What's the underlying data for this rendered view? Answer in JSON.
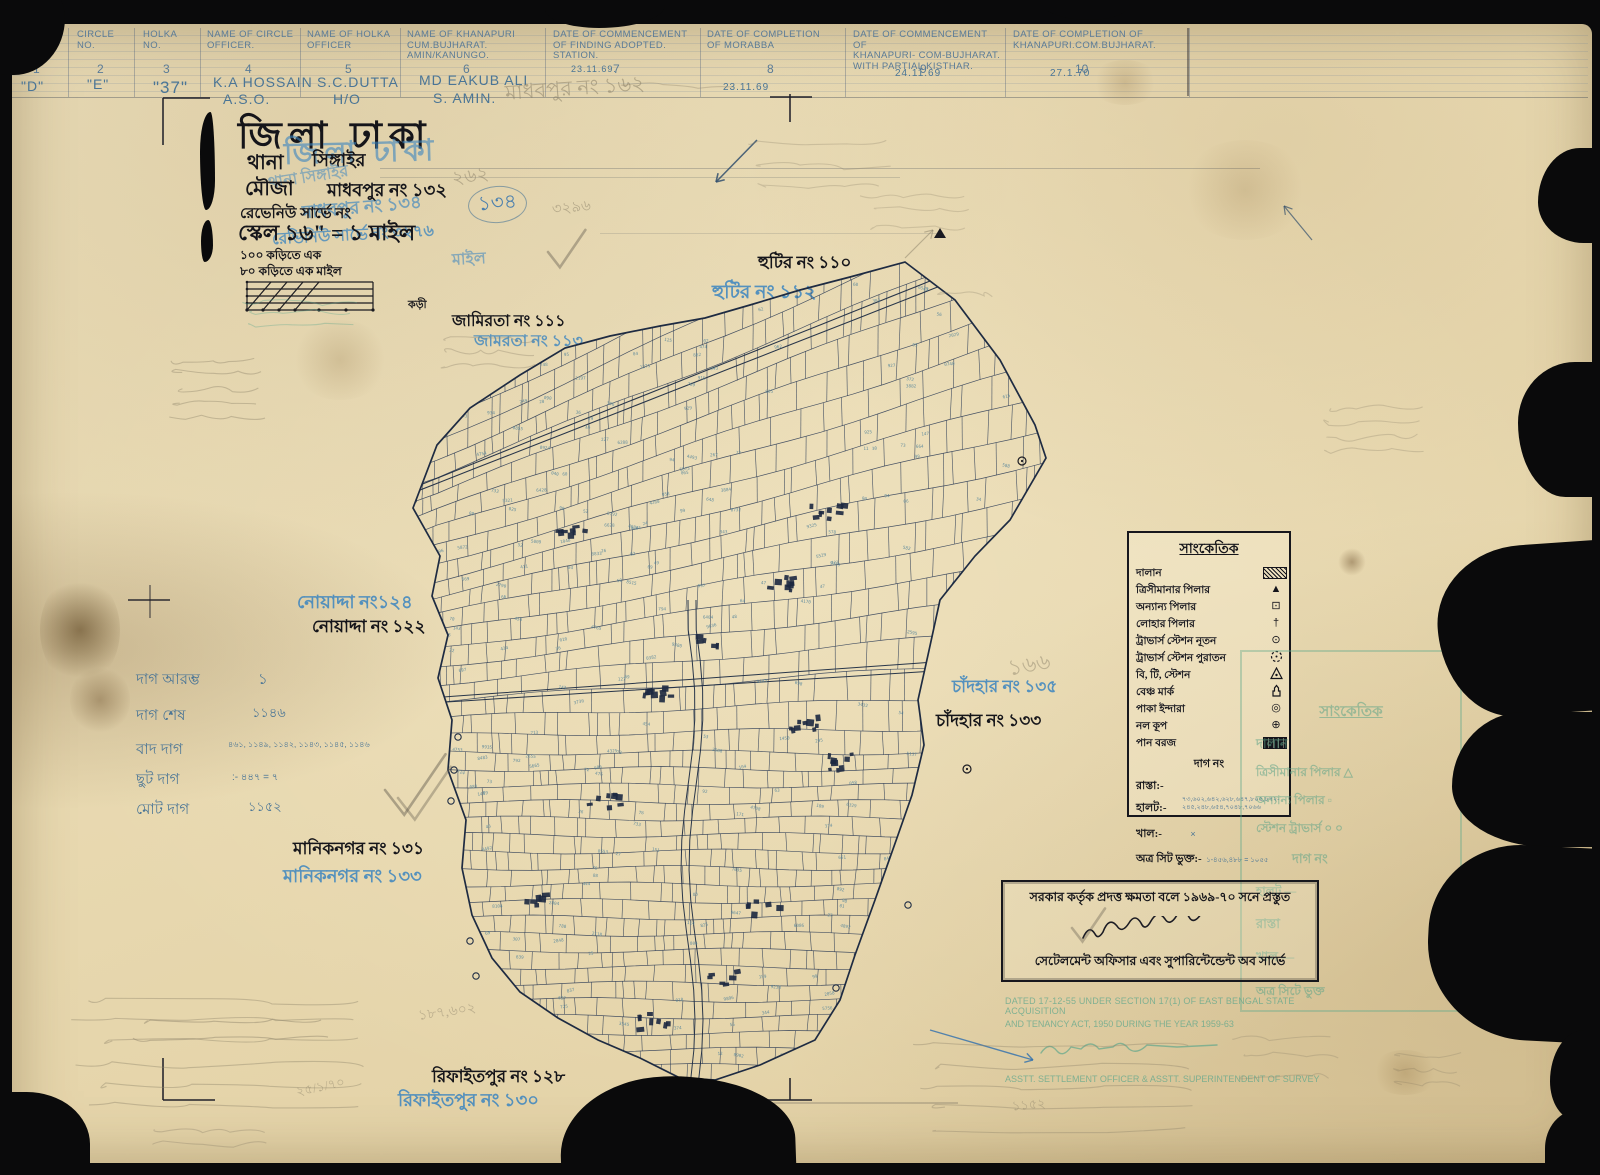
{
  "colors": {
    "paper": "#e9dcb6",
    "ink": "#15151a",
    "blue_stamp": "#3b85c0",
    "pencil": "#8b8169",
    "teal_stamp": "#58a58b",
    "map_ink": "#25334d",
    "map_numbers": "#527f91"
  },
  "header": {
    "columns": [
      {
        "no": "1",
        "label": "BLOCK\nNO.",
        "value": "\"D\"",
        "value2": ""
      },
      {
        "no": "2",
        "label": "CIRCLE\nNO.",
        "value": "\"E\"",
        "value2": ""
      },
      {
        "no": "3",
        "label": "HOLKA\nNO.",
        "value": "\"37\"",
        "value2": ""
      },
      {
        "no": "4",
        "label": "NAME OF CIRCLE\nOFFICER.",
        "value": "K.A HOSSAIN",
        "value2": "A.S.O."
      },
      {
        "no": "5",
        "label": "NAME OF HOLKA\nOFFICER",
        "value": "S.C.DUTTA",
        "value2": "H/O"
      },
      {
        "no": "6",
        "label": "NAME OF KHANAPURI\nCUM.BUJHARAT.\nAMIN/KANUNGO.",
        "value": "MD EAKUB ALI",
        "value2": "S. AMIN."
      },
      {
        "no": "7",
        "label": "DATE OF COMMENCEMENT\nOF FINDING ADOPTED.\nSTATION.",
        "value": "23.11.69.",
        "value2": ""
      },
      {
        "no": "8",
        "label": "DATE OF COMPLETION\nOF MORABBA",
        "value": "23.11.69",
        "value2": ""
      },
      {
        "no": "9",
        "label": "DATE OF COMMENCEMENT OF\nKHANAPURI- COM-BUJHARAT.\nWITH PARTIAL KISTHAR.",
        "value": "24.11.69",
        "value2": ""
      },
      {
        "no": "10",
        "label": "DATE OF COMPLETION OF\nKHANAPURI.COM.BUJHARAT.",
        "value": "27.1.70",
        "value2": ""
      }
    ],
    "pencil_note": "মাধবপুর নং ১৬২"
  },
  "title_block": {
    "district_black": "জিলা ঢাকা",
    "district_blue": "জিলা ঢাকা",
    "thana_label": "থানা",
    "thana_value": "সিঙ্গাইর",
    "thana_blue": "থানা সিঙ্গাইর",
    "mouza_label": "মৌজা",
    "mouza_value": "মাধবপুর নং ১৩২",
    "mouza_blue": "মাধবপুর নং ১৩৪",
    "mouza_blue_circled": "১৩৪",
    "revenue_line": "রেভেনিউ সার্ভে নং",
    "revenue_blue": "রেভিনিউ সার্ভে নং ৩২৭৬",
    "scale_line": "স্কেল ১৬\" = ১ মাইল",
    "scale_blue_tail": "মাইল",
    "kari_line1": "১০০ কড়িতে এক",
    "kari_line2": "৮০ কড়িতে এক মাইল",
    "scalebar_unit": "কড়ী",
    "pencil_262": "২৬২",
    "pencil_162": "১৬২",
    "pencil_3296": "৩২৯৬"
  },
  "neighbors": {
    "hutir": {
      "black": "হুটির নং ১১০",
      "blue": "হুটির নং ১১২"
    },
    "jamirta": {
      "black": "জামিরতা নং ১১১",
      "blue": "জামরতা নং ১১৩"
    },
    "noyadda": {
      "blue": "নোয়াদ্দা নং১২৪",
      "black": "নোয়াদ্দা নং ১২২"
    },
    "maniknagar": {
      "black": "মানিকনগর নং ১৩১",
      "blue": "মানিকনগর নং ১৩৩"
    },
    "chandhar": {
      "blue": "চাঁদহার নং ১৩৫",
      "black": "চাঁদহার নং ১৩৩",
      "pencil": "১৬৬"
    },
    "rifaitpur": {
      "black": "রিফাইতপুর নং ১২৮",
      "blue": "রিফাইতপুর নং ১৩০"
    }
  },
  "stats": {
    "rows": [
      {
        "label": "দাগ আরম্ভ",
        "value": "১"
      },
      {
        "label": "দাগ শেষ",
        "value": "১১৪৬"
      },
      {
        "label": "বাদ দাগ",
        "value": "৪৬১, ১১৪৯, ১১৪২, ১১৪৩, ১১৪৫, ১১৪৬"
      },
      {
        "label": "ছুট দাগ",
        "value": ":- ৪৪৭ = ৭"
      },
      {
        "label": "মোট দাগ",
        "value": "১১৫২"
      }
    ]
  },
  "legend": {
    "title": "সাংকেতিক",
    "rows": [
      {
        "label": "দালান",
        "symbol": "hatched-rect"
      },
      {
        "label": "ত্রিসীমানার পিলার",
        "symbol": "triangle"
      },
      {
        "label": "অন্যান্য পিলার",
        "symbol": "square-dot"
      },
      {
        "label": "লোহার পিলার",
        "symbol": "dagger"
      },
      {
        "label": "ট্রাভার্স স্টেশন নূতন",
        "symbol": "circle-dot"
      },
      {
        "label": "ট্রাভার্স স্টেশন পুরাতন",
        "symbol": "dashed-circle"
      },
      {
        "label": "বি, টি, স্টেশন",
        "symbol": "triangle-dot"
      },
      {
        "label": "বেঞ্চ মার্ক",
        "symbol": "benchmark"
      },
      {
        "label": "পাকা ইন্দারা",
        "symbol": "double-circle"
      },
      {
        "label": "নল কূপ",
        "symbol": "circle-cross"
      },
      {
        "label": "পান বরজ",
        "symbol": "dark-hatched-rect"
      }
    ],
    "dag_no": "দাগ নং",
    "rasta": "রাস্তা:-",
    "halot": "হালট:-",
    "halot_numbers": "৭৩,৬০২,৬৪২,৬২৮,৬৪৭,৮০৫,৮৭২-\n২৪৫,২৪৮,৬৫৪,৭০৪৮,৭০৬৬",
    "khal": "খাল:-",
    "khal_value": "×",
    "sheet": "অত্র সিট ভুক্ত:-",
    "sheet_numbers": "১-৪৫৬,৪৮৮ = ১০৫৫"
  },
  "green_legend": {
    "title": "সাংকেতিক",
    "lines": [
      "দালান",
      "ত্রিসীমানার পিলার   △",
      "অন্যান্য পিলার   ▫",
      "স্টেশন  ট্রাভার্স   ০ ০",
      "দাগ নং",
      "হালট  —",
      "রাস্তা",
      "খাল  —",
      "অত্র সিটে ভুক্ত"
    ]
  },
  "stamp": {
    "line1": "সরকার কর্তৃক প্রদত্ত ক্ষমতা বলে ১৯৬৯-৭০ সনে প্রস্তুত",
    "line2": "সেটেলমেন্ট অফিসার এবং সুপারিন্টেন্ডেন্ট অব সার্ভে"
  },
  "green_stamp": {
    "line1": "DATED 17-12-55 UNDER SECTION 17(1) OF EAST BENGAL STATE ACQUISITION",
    "line2": "AND TENANCY ACT, 1950 DURING THE YEAR 1959-63",
    "line3": "ASSTT. SETTLEMENT OFFICER & ASSTT. SUPERINTENDENT OF SURVEY"
  },
  "pencil_notes": {
    "bottom_left_1": "১৮৭,৬০২",
    "bottom_left_2": "২৫/১/৭০",
    "bottom_right_1": "১১৫২"
  }
}
